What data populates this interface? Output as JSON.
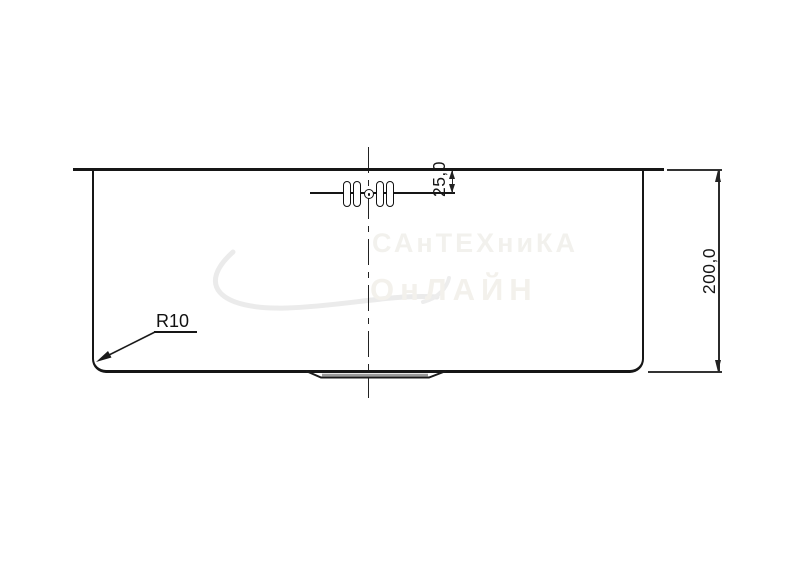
{
  "drawing": {
    "type": "technical-drawing-sink-side-view",
    "dim_height": {
      "label": "200,0"
    },
    "dim_overflow": {
      "label": "25,0"
    },
    "radius_callout": {
      "label": "R10"
    },
    "watermark": {
      "line1": "САнТЕХниКА",
      "line2": "ОнЛАЙН"
    },
    "colors": {
      "line": "#161616",
      "dim_line": "#2b2b2b",
      "watermark": "#f2f1ed"
    }
  }
}
